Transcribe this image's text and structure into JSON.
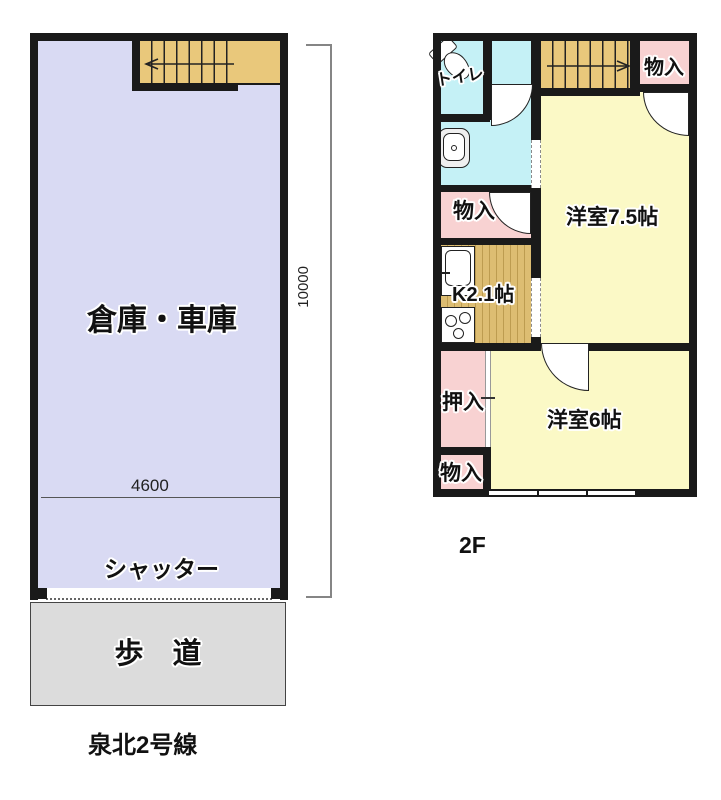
{
  "floor1": {
    "room": "倉庫・車庫",
    "shutter": "シャッター",
    "sidewalk": "歩　道",
    "road": "泉北2号線",
    "width_dim": "4600",
    "height_dim": "10000"
  },
  "floor2": {
    "floor_label": "2F",
    "toilet": "トイレ",
    "storage_top_right": "物入",
    "storage_mid_left": "物入",
    "kitchen": "K2.1帖",
    "western_room_75": "洋室7.5帖",
    "closet": "押入",
    "storage_bottom_left": "物入",
    "western_room_6": "洋室6帖"
  },
  "colors": {
    "wall": "#1a1a1a",
    "garage_floor": "#d9daf3",
    "stairs": "#e9c87b",
    "washroom": "#c5f1f6",
    "rooms_yellow": "#fbf9c6",
    "storage_pink": "#f8d2d2",
    "kitchen_floor": "#ddbd72",
    "sidewalk": "#dcdcdc"
  }
}
